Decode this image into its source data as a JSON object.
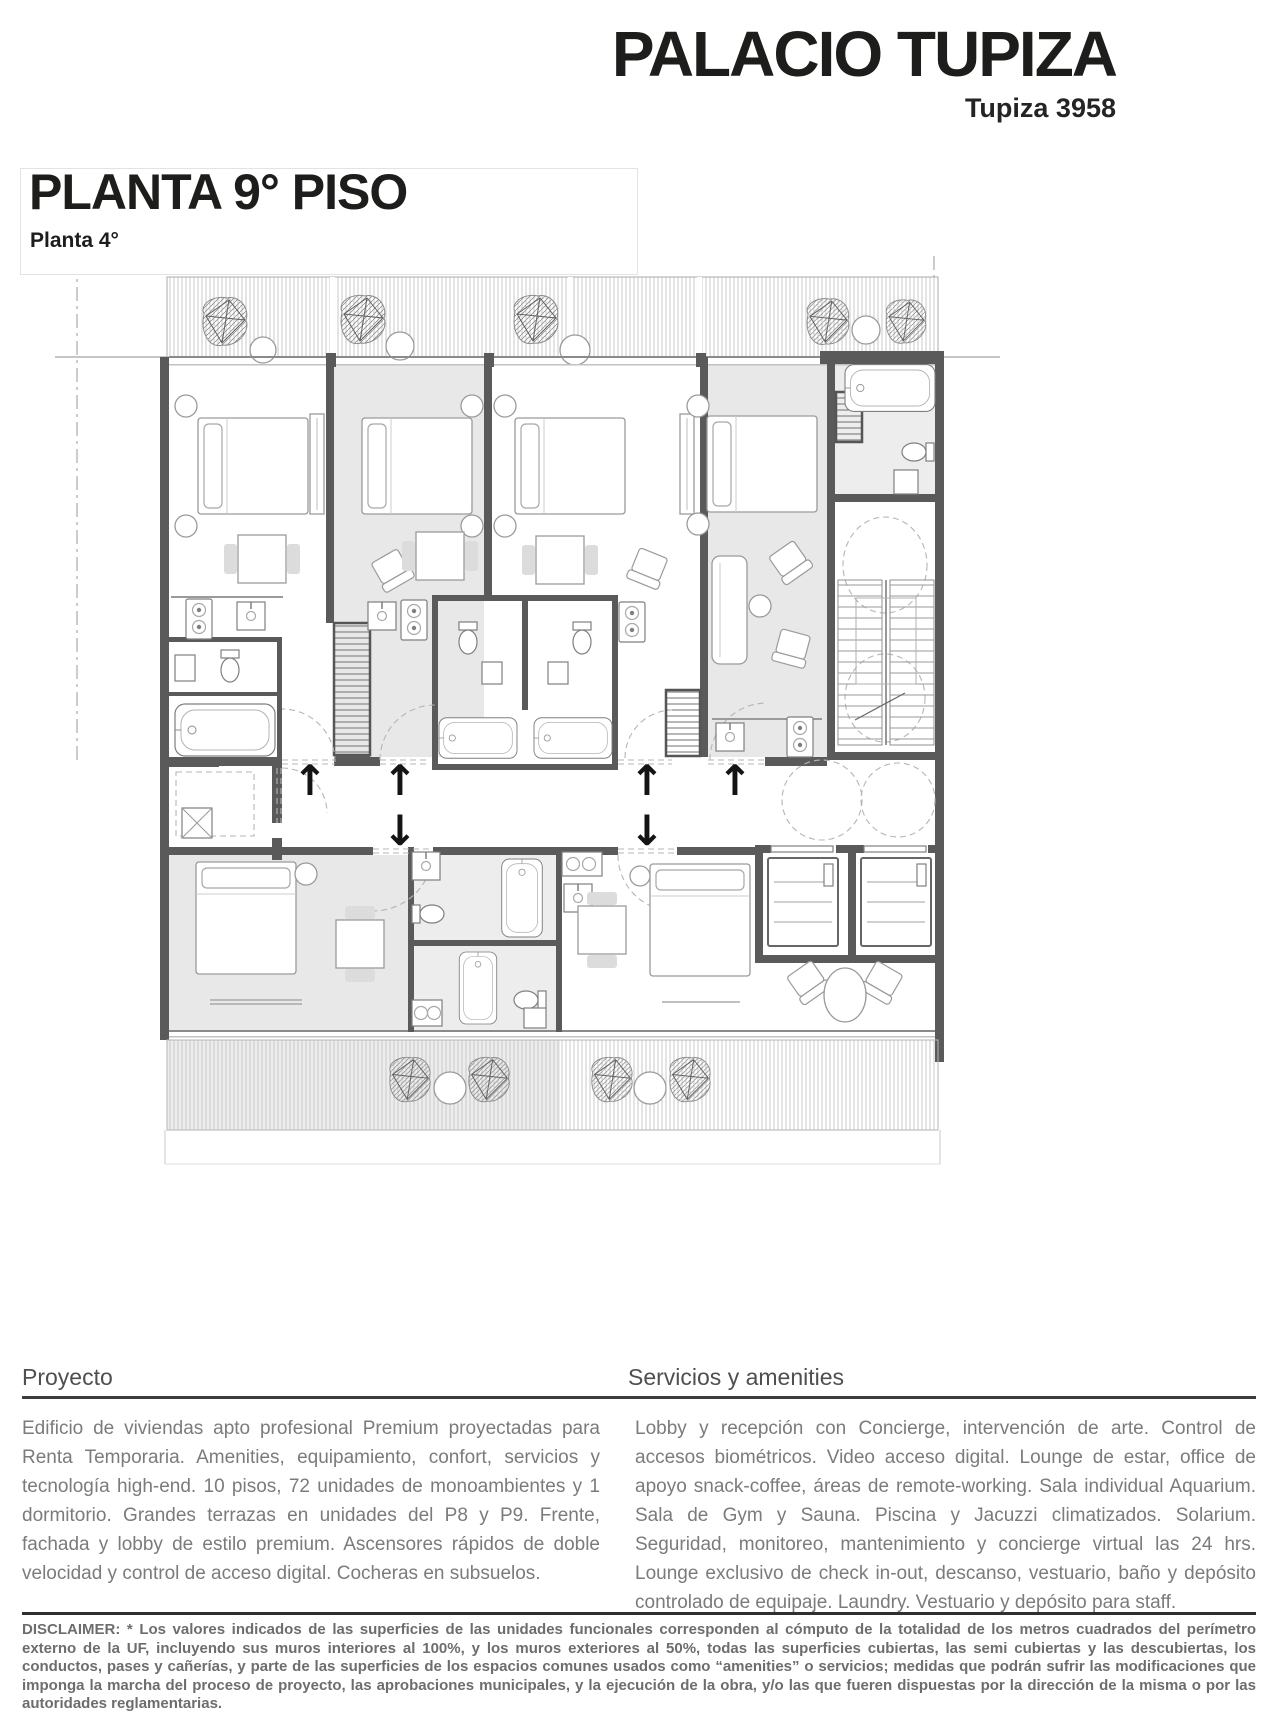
{
  "header": {
    "title": "PALACIO TUPIZA",
    "address": "Tupiza 3958"
  },
  "plan": {
    "title": "PLANTA 9° PISO",
    "subtitle": "Planta 4°",
    "arrow_up": "↑",
    "arrow_down": "↓"
  },
  "sections": {
    "project": {
      "heading": "Proyecto",
      "body": "Edificio de viviendas apto profesional Premium proyectadas para Renta Temporaria. Amenities, equipamiento, confort, servicios y tecnología high-end. 10 pisos, 72 unidades de monoambientes y 1 dormitorio. Grandes terrazas en unidades del P8 y P9. Frente, fachada y lobby de estilo premium. Ascensores rápidos de doble velocidad y control de acceso digital. Cocheras en subsuelos."
    },
    "services": {
      "heading": "Servicios y amenities",
      "body": "Lobby y recepción con Concierge, intervención de arte. Control de accesos biométricos. Video acceso digital. Lounge de estar, office de apoyo snack-coffee, áreas de remote-working. Sala individual Aquarium. Sala de Gym y Sauna. Piscina y Jacuzzi climatizados. Solarium. Seguridad, monitoreo, mantenimiento y concierge virtual las 24 hrs. Lounge exclusivo de check in-out, descanso, vestuario, baño y depósito controlado de equipaje. Laundry. Vestuario y depósito para staff."
    }
  },
  "disclaimer": {
    "label": "DISCLAIMER:",
    "body": " * Los valores indicados de las superficies de las unidades funcionales corresponden al cómputo de la totalidad de los metros cuadrados del perímetro externo de la UF, incluyendo sus muros interiores al 100%, y los muros exteriores al 50%, todas las superficies cubiertas, las semi cubiertas y las descubiertas, los conductos, pases y cañerías, y parte de las superficies de los espacios comunes usados como “amenities” o servicios; medidas que podrán sufrir las modificaciones que imponga la marcha del proceso de proyecto, las aprobaciones municipales, y la ejecución de la obra, y/o las que fueren dispuestas por la dirección de la misma o por las autoridades reglamentarias."
  },
  "colors": {
    "heading_text": "#1d1d1b",
    "section_heading": "#4f4f4f",
    "body_text": "#7b7b7b",
    "disclaimer_text": "#6d6d6d",
    "wall": "#5a5a5a",
    "room_shade": "#e8e8e8",
    "hatch": "#c9c9c9"
  }
}
